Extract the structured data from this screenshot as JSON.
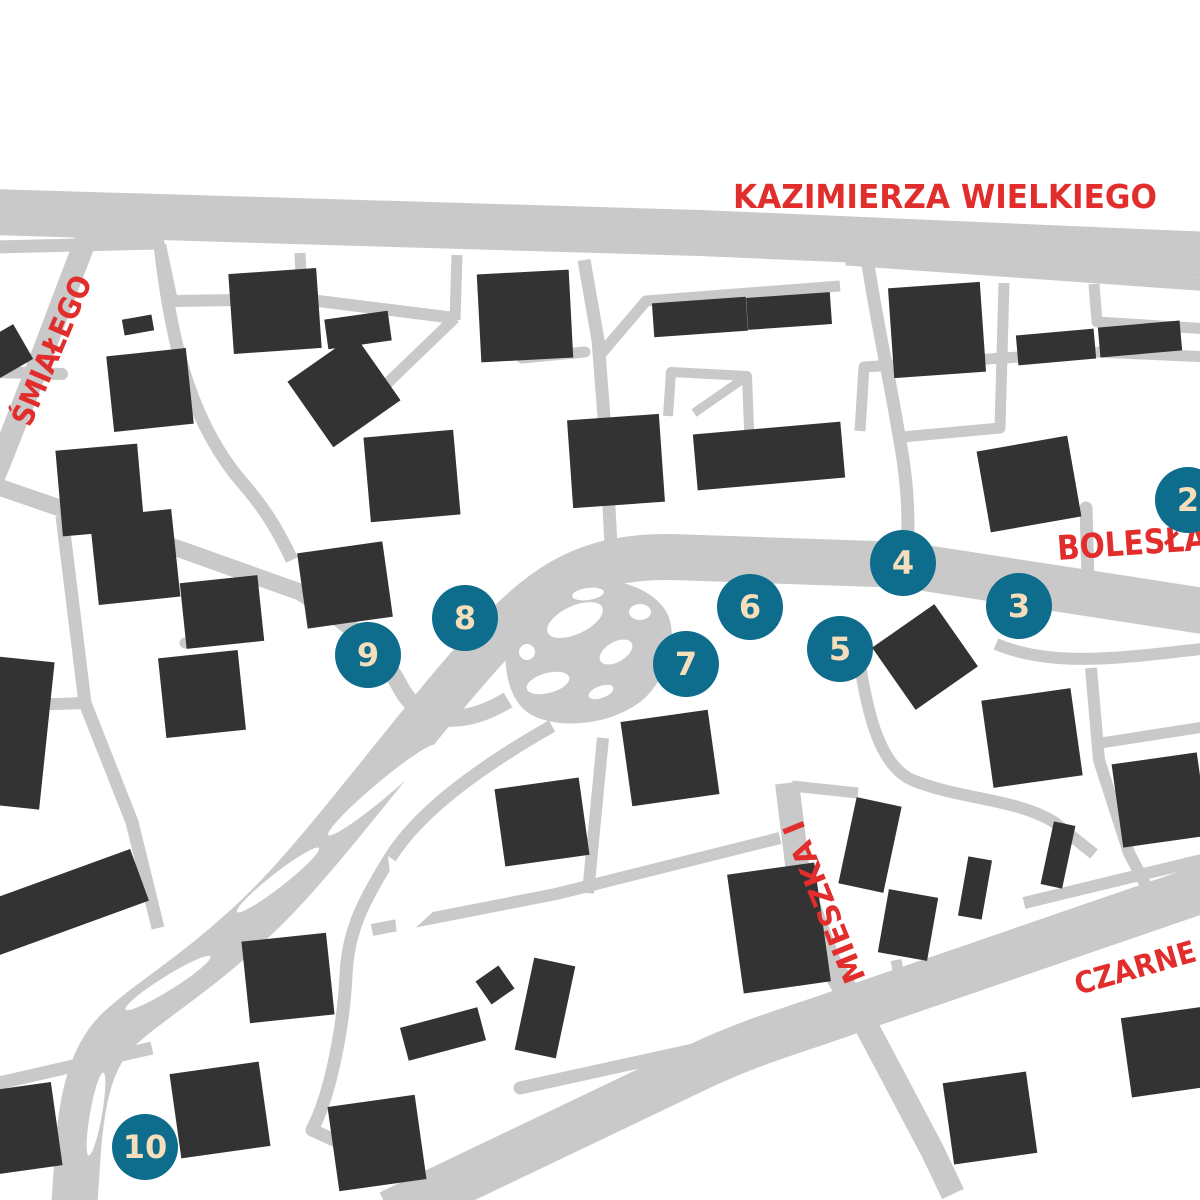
{
  "map": {
    "background": "#ffffff",
    "colors": {
      "road": "#c9c9c9",
      "building": "#333333",
      "label": "#e22d2d",
      "marker": "#0e6c8c",
      "marker_text": "#f6deba"
    },
    "street_labels": [
      {
        "id": "kazimierza-wielkiego",
        "text": "KAZIMIERZA WIELKIEGO",
        "x": 945,
        "y": 208,
        "rot": 0,
        "size": 33,
        "anchor": "middle",
        "len": 424
      },
      {
        "id": "smialego",
        "text": "ŚMIAŁEGO",
        "x": 30,
        "y": 428,
        "rot": -67,
        "size": 30,
        "anchor": "start",
        "len": 160
      },
      {
        "id": "boleslawa",
        "text": "BOLESŁA",
        "x": 1058,
        "y": 560,
        "rot": -4,
        "size": 34,
        "anchor": "start",
        "len": 150
      },
      {
        "id": "mieszka-i",
        "text": "MIESZKA I",
        "x": 866,
        "y": 978,
        "rot": -112,
        "size": 30,
        "anchor": "start",
        "len": 172
      },
      {
        "id": "czarne",
        "text": "CZARNE",
        "x": 1078,
        "y": 995,
        "rot": -16,
        "size": 30,
        "anchor": "start",
        "len": 125
      }
    ],
    "markers": [
      {
        "number": "2",
        "x": 1188,
        "y": 500
      },
      {
        "number": "3",
        "x": 1019,
        "y": 606
      },
      {
        "number": "4",
        "x": 903,
        "y": 563
      },
      {
        "number": "5",
        "x": 840,
        "y": 649
      },
      {
        "number": "6",
        "x": 750,
        "y": 607
      },
      {
        "number": "7",
        "x": 686,
        "y": 664
      },
      {
        "number": "8",
        "x": 465,
        "y": 618
      },
      {
        "number": "9",
        "x": 368,
        "y": 655
      },
      {
        "number": "10",
        "x": 145,
        "y": 1147
      }
    ],
    "roads": [
      {
        "d": "M -10 212 L 700 233 L 1210 255",
        "w": 46,
        "cap": "butt"
      },
      {
        "d": "M 846 259 L 1210 285",
        "w": 13,
        "cap": "butt"
      },
      {
        "d": "M 92 224 C 62 300 34 380 -12 492",
        "w": 22,
        "cap": "butt"
      },
      {
        "d": "M 1210 612 L 905 565 L 672 557 C 590 556 548 582 495 638 C 420 718 330 846 262 912 C 200 972 150 1000 118 1030 C 90 1058 82 1100 78 1150 L 74 1210",
        "w": 46,
        "cap": "butt"
      },
      {
        "d": "M 867 258 C 878 330 890 380 898 430 C 908 482 910 522 906 560",
        "w": 13,
        "cap": "butt"
      },
      {
        "d": "M 584 260 L 598 340 L 605 430 L 612 565",
        "w": 13,
        "cap": "butt"
      },
      {
        "d": "M 600 355 L 646 301 L 840 286",
        "w": 11,
        "cap": "butt"
      },
      {
        "d": "M 668 416 L 671 372 L 747 376 L 751 480",
        "w": 10,
        "cap": "butt"
      },
      {
        "d": "M 694 413 L 743 379",
        "w": 9,
        "cap": "butt"
      },
      {
        "d": "M 1004 283 L 1000 428",
        "w": 11,
        "cap": "butt"
      },
      {
        "d": "M 1000 428 L 902 437",
        "w": 11,
        "cap": "round"
      },
      {
        "d": "M 860 431 L 864 367 L 1097 352",
        "w": 11,
        "cap": "butt"
      },
      {
        "d": "M 1097 352 L 1210 357",
        "w": 11,
        "cap": "butt"
      },
      {
        "d": "M 1094 284 L 1097 322 L 1210 329",
        "w": 11,
        "cap": "butt"
      },
      {
        "d": "M 1086 508 L 1088 578",
        "w": 13,
        "cap": "round"
      },
      {
        "d": "M -5 247 L 158 243",
        "w": 13,
        "cap": "round"
      },
      {
        "d": "M 160 245 L 172 301",
        "w": 12,
        "cap": "butt"
      },
      {
        "d": "M 172 301 L 302 299 L 455 318",
        "w": 12,
        "cap": "butt"
      },
      {
        "d": "M 300 253 L 302 299",
        "w": 11,
        "cap": "butt"
      },
      {
        "d": "M 457 255 L 455 320",
        "w": 11,
        "cap": "butt"
      },
      {
        "d": "M 455 318 L 372 398",
        "w": 11,
        "cap": "butt"
      },
      {
        "d": "M 522 358 L 585 352",
        "w": 11,
        "cap": "round"
      },
      {
        "d": "M 160 245 C 170 330 186 420 246 487 C 264 508 278 530 292 560",
        "w": 13,
        "cap": "butt"
      },
      {
        "d": "M -5 372 L 62 374",
        "w": 12,
        "cap": "round"
      },
      {
        "d": "M -10 484 L 185 551 L 300 592 C 362 632 382 652 402 690 C 424 728 468 724 508 700",
        "w": 17,
        "cap": "butt"
      },
      {
        "d": "M 62 516 L 85 703 L 132 822 L 158 928",
        "w": 13,
        "cap": "butt"
      },
      {
        "d": "M -5 706 L 85 703",
        "w": 12,
        "cap": "butt"
      },
      {
        "d": "M 185 643 L 256 636",
        "w": 11,
        "cap": "round"
      },
      {
        "d": "M 552 726 C 482 766 420 810 390 858 C 364 900 348 930 346 975 C 344 1020 332 1092 312 1130 L 462 1198",
        "w": 13,
        "cap": "butt"
      },
      {
        "d": "M 372 930 L 556 894 L 780 838",
        "w": 12,
        "cap": "butt"
      },
      {
        "d": "M 603 738 L 588 893",
        "w": 12,
        "cap": "butt"
      },
      {
        "d": "M 787 783 L 799 880 L 829 962 L 859 1012 L 932 1150 L 953 1194",
        "w": 24,
        "cap": "butt"
      },
      {
        "d": "M 792 786 L 858 793",
        "w": 11,
        "cap": "butt"
      },
      {
        "d": "M 858 652 C 868 722 882 766 912 780 C 962 800 1014 798 1054 822 L 1094 854",
        "w": 12,
        "cap": "butt"
      },
      {
        "d": "M 996 644 C 1052 668 1122 658 1210 648",
        "w": 12,
        "cap": "butt"
      },
      {
        "d": "M 1091 668 L 1099 760 L 1129 853 L 1153 899",
        "w": 12,
        "cap": "butt"
      },
      {
        "d": "M 1101 743 L 1210 726",
        "w": 11,
        "cap": "butt"
      },
      {
        "d": "M 1024 903 L 1210 858",
        "w": 12,
        "cap": "butt"
      },
      {
        "d": "M 390 1214 L 700 1066 C 760 1038 802 1028 862 1006 L 1240 876",
        "w": 48,
        "cap": "butt"
      },
      {
        "d": "M 520 1088 L 730 1042",
        "w": 13,
        "cap": "round"
      },
      {
        "d": "M -5 1084 L 152 1048",
        "w": 13,
        "cap": "butt"
      },
      {
        "d": "M 896 960 L 904 1003",
        "w": 11,
        "cap": "butt"
      }
    ],
    "road_areas": [
      {
        "d": "M 505 648 C 505 610 530 585 570 580 C 615 575 655 588 668 615 C 678 640 668 675 645 698 C 618 722 570 730 538 718 C 512 708 505 680 505 648 Z"
      }
    ],
    "islands_ellipse": [
      {
        "cx": 575,
        "cy": 620,
        "rx": 30,
        "ry": 14,
        "rot": -25
      },
      {
        "cx": 616,
        "cy": 652,
        "rx": 18,
        "ry": 10,
        "rot": -30
      },
      {
        "cx": 548,
        "cy": 683,
        "rx": 22,
        "ry": 10,
        "rot": -15
      },
      {
        "cx": 640,
        "cy": 612,
        "rx": 11,
        "ry": 8,
        "rot": 0
      },
      {
        "cx": 527,
        "cy": 652,
        "rx": 8,
        "ry": 8,
        "rot": 0
      },
      {
        "cx": 601,
        "cy": 692,
        "rx": 13,
        "ry": 6,
        "rot": -20
      },
      {
        "cx": 588,
        "cy": 594,
        "rx": 16,
        "ry": 6,
        "rot": -8
      },
      {
        "cx": 338,
        "cy": 696,
        "rx": 16,
        "ry": 10,
        "rot": -30
      },
      {
        "cx": 374,
        "cy": 694,
        "rx": 12,
        "ry": 8,
        "rot": -25
      },
      {
        "cx": 382,
        "cy": 790,
        "rx": 70,
        "ry": 8,
        "rot": -40
      },
      {
        "cx": 278,
        "cy": 880,
        "rx": 52,
        "ry": 7,
        "rot": -38
      },
      {
        "cx": 168,
        "cy": 983,
        "rx": 50,
        "ry": 7,
        "rot": -32
      },
      {
        "cx": 96,
        "cy": 1114,
        "rx": 42,
        "ry": 6,
        "rot": -80
      }
    ],
    "islands_polygon": [
      {
        "points": "472,790 548,764 562,826"
      },
      {
        "points": "388,856 448,898 398,944"
      }
    ],
    "buildings": [
      {
        "x": 275,
        "y": 311,
        "w": 88,
        "h": 80,
        "r": -4
      },
      {
        "x": 525,
        "y": 316,
        "w": 92,
        "h": 88,
        "r": -3
      },
      {
        "x": 700,
        "y": 317,
        "w": 94,
        "h": 34,
        "r": -4
      },
      {
        "x": 789,
        "y": 311,
        "w": 84,
        "h": 32,
        "r": -4
      },
      {
        "x": 937,
        "y": 330,
        "w": 92,
        "h": 90,
        "r": -4
      },
      {
        "x": 1056,
        "y": 347,
        "w": 78,
        "h": 30,
        "r": -5
      },
      {
        "x": 1140,
        "y": 339,
        "w": 82,
        "h": 30,
        "r": -5
      },
      {
        "x": 150,
        "y": 390,
        "w": 80,
        "h": 76,
        "r": -6
      },
      {
        "x": 344,
        "y": 391,
        "w": 82,
        "h": 80,
        "r": -35
      },
      {
        "x": 358,
        "y": 330,
        "w": 64,
        "h": 30,
        "r": -8
      },
      {
        "x": 138,
        "y": 325,
        "w": 30,
        "h": 16,
        "r": -10
      },
      {
        "x": 5,
        "y": 352,
        "w": 42,
        "h": 40,
        "r": -30
      },
      {
        "x": 100,
        "y": 490,
        "w": 82,
        "h": 86,
        "r": -5
      },
      {
        "x": 412,
        "y": 476,
        "w": 90,
        "h": 85,
        "r": -5
      },
      {
        "x": 616,
        "y": 461,
        "w": 92,
        "h": 88,
        "r": -4
      },
      {
        "x": 769,
        "y": 456,
        "w": 148,
        "h": 56,
        "r": -5
      },
      {
        "x": 1029,
        "y": 484,
        "w": 92,
        "h": 82,
        "r": -10
      },
      {
        "x": 135,
        "y": 557,
        "w": 82,
        "h": 88,
        "r": -6
      },
      {
        "x": 222,
        "y": 612,
        "w": 78,
        "h": 66,
        "r": -6
      },
      {
        "x": 202,
        "y": 694,
        "w": 80,
        "h": 80,
        "r": -6
      },
      {
        "x": 345,
        "y": 585,
        "w": 86,
        "h": 76,
        "r": -8
      },
      {
        "x": 18,
        "y": 733,
        "w": 58,
        "h": 148,
        "r": 6
      },
      {
        "x": 670,
        "y": 758,
        "w": 88,
        "h": 85,
        "r": -8
      },
      {
        "x": 542,
        "y": 822,
        "w": 85,
        "h": 78,
        "r": -8
      },
      {
        "x": 925,
        "y": 657,
        "w": 76,
        "h": 76,
        "r": -35
      },
      {
        "x": 1032,
        "y": 738,
        "w": 90,
        "h": 88,
        "r": -8
      },
      {
        "x": 1160,
        "y": 800,
        "w": 86,
        "h": 84,
        "r": -8
      },
      {
        "x": 1058,
        "y": 855,
        "w": 22,
        "h": 64,
        "r": 12
      },
      {
        "x": 975,
        "y": 888,
        "w": 24,
        "h": 60,
        "r": 10
      },
      {
        "x": 870,
        "y": 845,
        "w": 46,
        "h": 88,
        "r": 12
      },
      {
        "x": 908,
        "y": 925,
        "w": 50,
        "h": 64,
        "r": 10
      },
      {
        "x": 779,
        "y": 928,
        "w": 88,
        "h": 120,
        "r": -8
      },
      {
        "x": 62,
        "y": 903,
        "w": 165,
        "h": 55,
        "r": -20
      },
      {
        "x": 288,
        "y": 978,
        "w": 85,
        "h": 82,
        "r": -6
      },
      {
        "x": 495,
        "y": 985,
        "w": 28,
        "h": 28,
        "r": -35
      },
      {
        "x": 545,
        "y": 1008,
        "w": 42,
        "h": 94,
        "r": 12
      },
      {
        "x": 443,
        "y": 1034,
        "w": 80,
        "h": 34,
        "r": -15
      },
      {
        "x": 377,
        "y": 1143,
        "w": 88,
        "h": 85,
        "r": -8
      },
      {
        "x": 220,
        "y": 1110,
        "w": 90,
        "h": 85,
        "r": -8
      },
      {
        "x": 25,
        "y": 1128,
        "w": 64,
        "h": 84,
        "r": -8
      },
      {
        "x": 990,
        "y": 1118,
        "w": 84,
        "h": 82,
        "r": -8
      },
      {
        "x": 1168,
        "y": 1052,
        "w": 84,
        "h": 80,
        "r": -8
      }
    ]
  }
}
